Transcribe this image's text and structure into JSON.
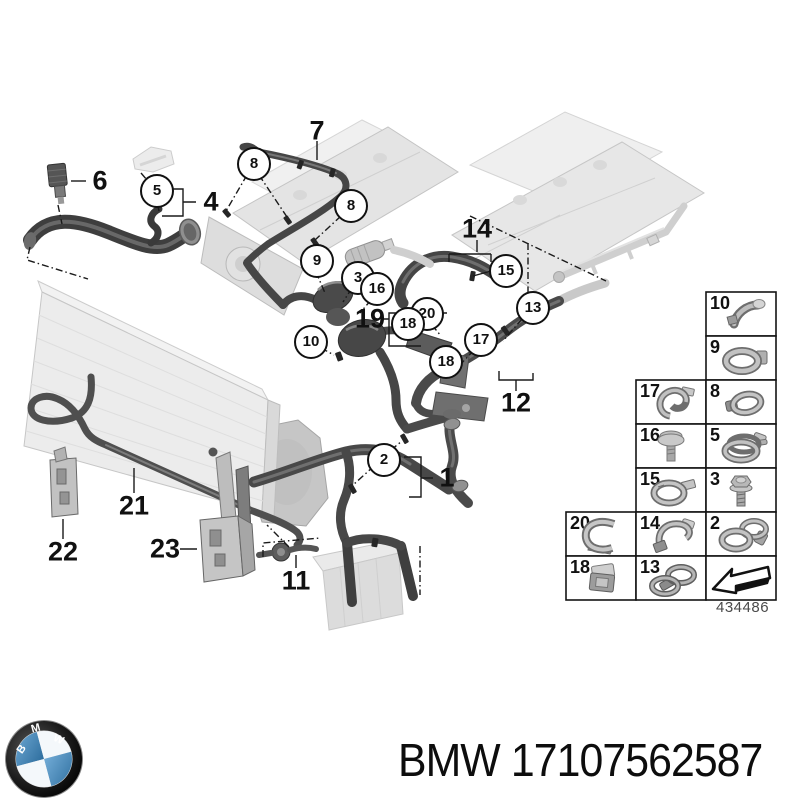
{
  "diagram": {
    "sheet_number": "434486",
    "plain_callouts": [
      {
        "label": "6"
      },
      {
        "label": "4"
      },
      {
        "label": "7"
      },
      {
        "label": "14"
      },
      {
        "label": "19"
      },
      {
        "label": "12"
      },
      {
        "label": "1"
      },
      {
        "label": "21"
      },
      {
        "label": "22"
      },
      {
        "label": "23"
      },
      {
        "label": "11"
      }
    ],
    "circled_callouts": [
      {
        "label": "5"
      },
      {
        "label": "8"
      },
      {
        "label": "8"
      },
      {
        "label": "9"
      },
      {
        "label": "3"
      },
      {
        "label": "16"
      },
      {
        "label": "15"
      },
      {
        "label": "13"
      },
      {
        "label": "20"
      },
      {
        "label": "18"
      },
      {
        "label": "17"
      },
      {
        "label": "18"
      },
      {
        "label": "10"
      },
      {
        "label": "2"
      }
    ],
    "colors": {
      "hose_dark": "#434343",
      "ghost_part": "#e6e6e6",
      "line": "#1a1a1a"
    }
  },
  "legend": {
    "cells": [
      {
        "label": "10",
        "icon": "hose-holder-icon"
      },
      {
        "label": "9",
        "icon": "ring-clamp-icon"
      },
      {
        "label": "17",
        "icon": "pipe-clip-icon"
      },
      {
        "label": "8",
        "icon": "hose-clamp-icon"
      },
      {
        "label": "16",
        "icon": "push-rivet-icon"
      },
      {
        "label": "5",
        "icon": "spring-band-clamp-icon"
      },
      {
        "label": "15",
        "icon": "tab-clamp-icon"
      },
      {
        "label": "3",
        "icon": "flange-bolt-icon"
      },
      {
        "label": "20",
        "icon": "retainer-clip-icon"
      },
      {
        "label": "14",
        "icon": "hook-clip-icon"
      },
      {
        "label": "2",
        "icon": "double-clamp-icon"
      },
      {
        "label": "18",
        "icon": "box-clip-icon"
      },
      {
        "label": "13",
        "icon": "double-ring-clamp-icon"
      },
      {
        "label": "",
        "icon": "direction-arrow-icon"
      }
    ]
  },
  "footer": {
    "brand": "BMW",
    "part_number": "17107562587",
    "logo_colors": {
      "roundel_blue": "#3f86b8",
      "ring_black": "#161616"
    }
  }
}
